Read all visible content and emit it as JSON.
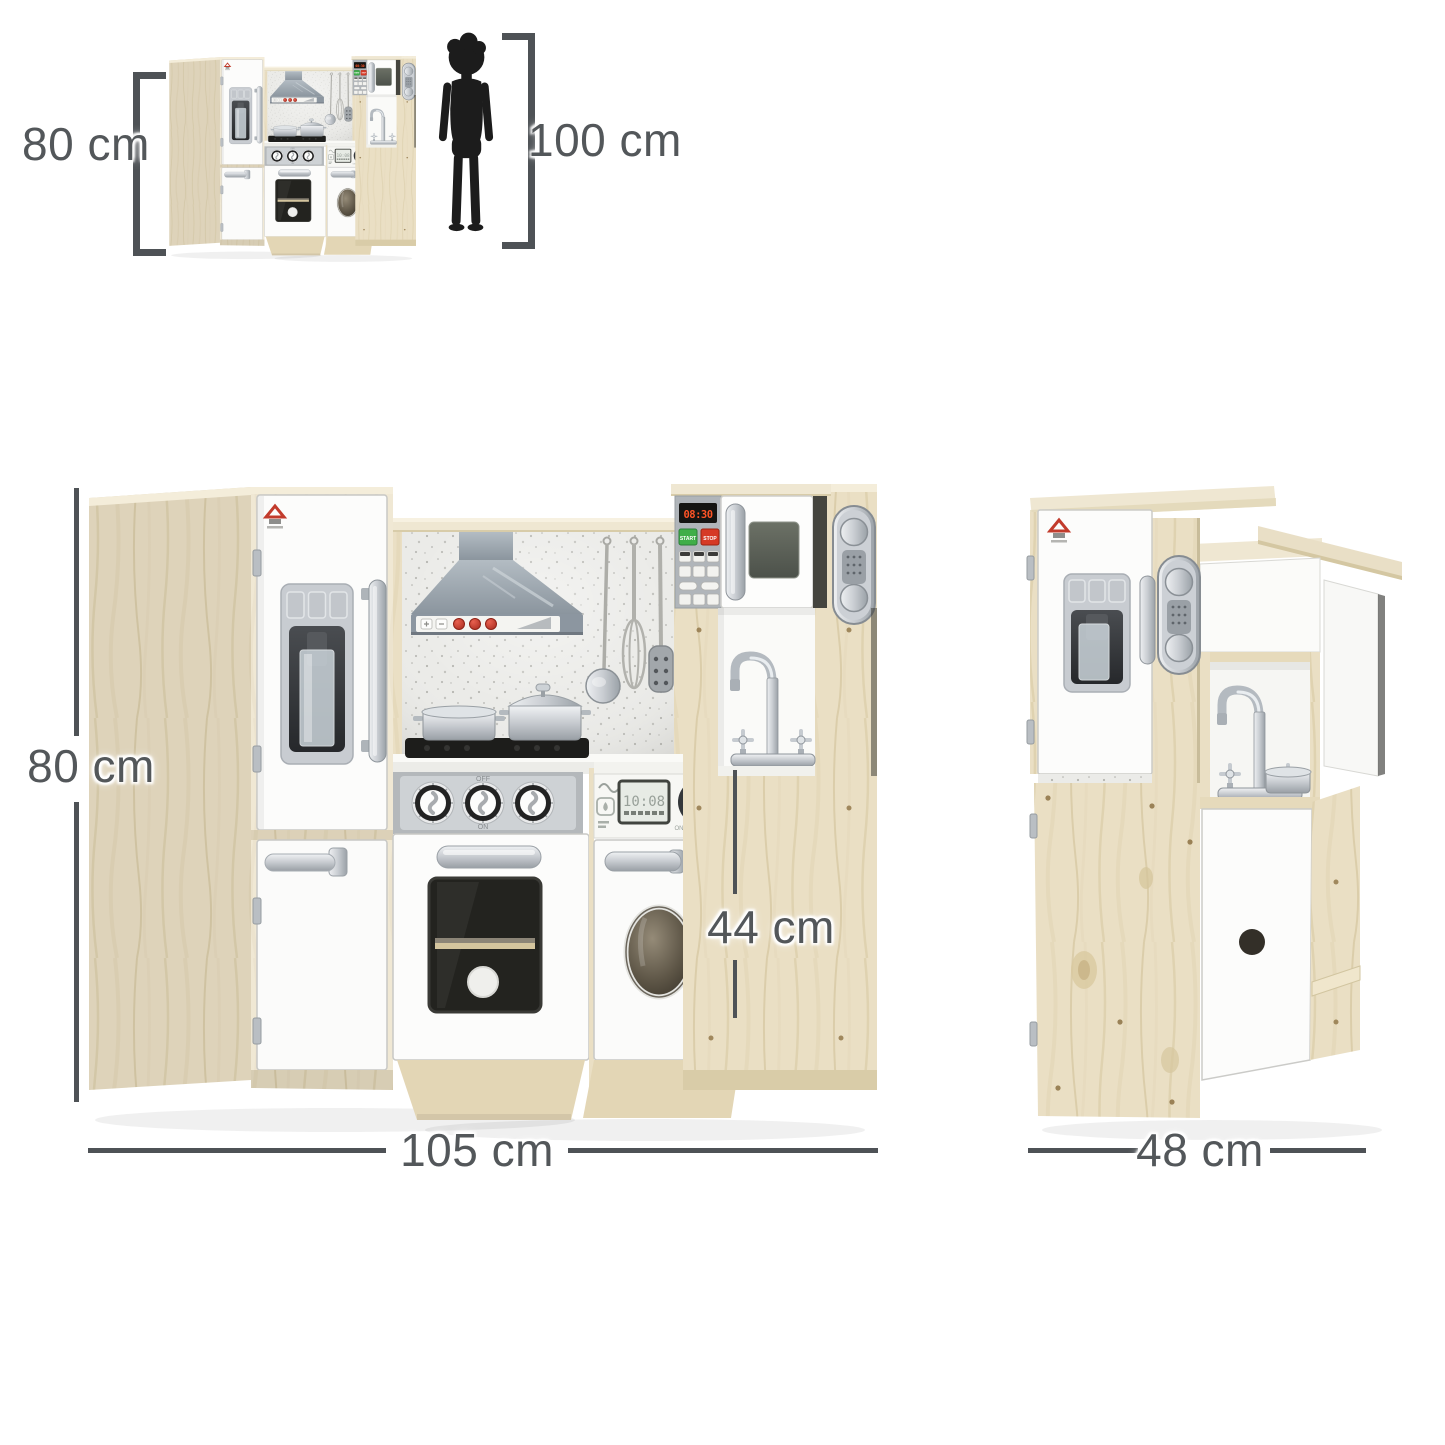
{
  "annotations": {
    "thumbnail_height_label": "80 cm",
    "child_height_label": "100 cm",
    "front_height_label": "80 cm",
    "front_width_label": "105 cm",
    "counter_height_label": "44 cm",
    "side_depth_label": "48 cm"
  },
  "appliance_text": {
    "microwave_clock": "08:30",
    "microwave_start": "START",
    "microwave_stop": "STOP",
    "washer_display": "10:08",
    "stove_knob_off": "OFF",
    "stove_knob_on": "ON",
    "washer_knob_on": "ON",
    "washer_knob_off": "OFF"
  },
  "colors": {
    "wood": "#eadfc4",
    "wood_shade": "#d8cba8",
    "panel_white": "#fbfbfb",
    "hood_gray": "#98a3ac",
    "backsplash_speckle": "#ebebe8",
    "dimension_gray": "#53575a",
    "silhouette_black": "#1c1c1c",
    "clock_red": "#ff5426",
    "start_green": "#3fae49",
    "stop_red": "#d63a26"
  },
  "icons": {
    "child": "child-silhouette",
    "brand": "homcom-logo",
    "hood": "range-hood-icon",
    "utensils": [
      "ladle-icon",
      "whisk-icon",
      "spatula-icon"
    ],
    "phone": "toy-phone-icon",
    "dispenser": "ice-dispenser-icon",
    "faucet": "faucet-icon"
  }
}
